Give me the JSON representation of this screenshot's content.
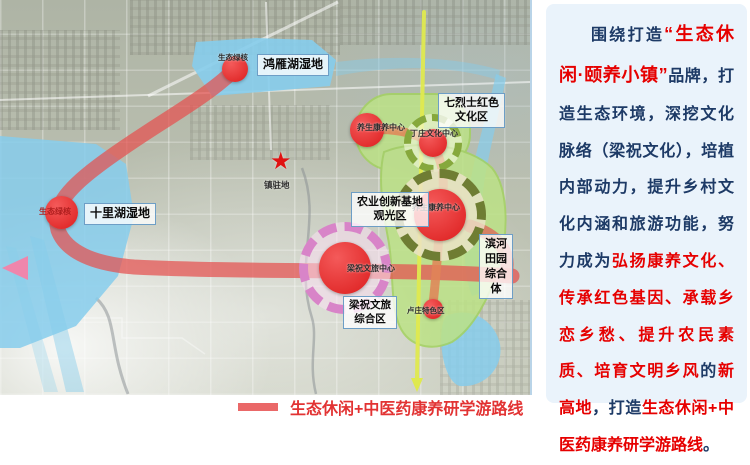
{
  "panel": {
    "segments": [
      {
        "style": "navy",
        "text": "围绕打造"
      },
      {
        "style": "brand",
        "text": "“生态休闲·颐养小镇”"
      },
      {
        "style": "navy",
        "text": "品牌，打造生态环境，深挖文化脉络（梁祝文化），培植内部动力，提升乡村文化内涵和旅游功能，努力成为"
      },
      {
        "style": "red",
        "text": "弘扬康养文化、传承红色基因、承载乡恋乡愁、提升农民素质、培育文明乡风"
      },
      {
        "style": "navy",
        "text": "的"
      },
      {
        "style": "red",
        "text": "新高地"
      },
      {
        "style": "navy",
        "text": "，打造"
      },
      {
        "style": "red",
        "text": "生态休闲+中医药康养研学游路线"
      },
      {
        "style": "navy",
        "text": "。"
      }
    ]
  },
  "legend": {
    "route_label": "生态休闲+中医药康养研学游路线"
  },
  "map": {
    "areas": {
      "hongyan_wetland": "鸿雁湖湿地",
      "shilihu_wetland": "十里湖湿地",
      "qilieshi_line1": "七烈士红色",
      "qilieshi_line2": "文化区",
      "nongye_line1": "农业创新基地",
      "nongye_line2": "观光区",
      "binhe_line1": "滨河",
      "binhe_line2": "田园",
      "binhe_line3": "综合",
      "binhe_line4": "体",
      "liangzhu_line1": "梁祝文旅",
      "liangzhu_line2": "综合区"
    },
    "nodes": {
      "eco_core_top": "生态绿核",
      "eco_core_west": "生态绿核",
      "yangsheng_center": "养生康养中心",
      "dingzhuang_center": "丁庄文化中心",
      "kangyang_center": "养生康养中心",
      "liangzhu_center": "梁祝文旅中心",
      "luzhuang_zone": "卢庄特色区",
      "town_seat": "镇驻地"
    }
  },
  "colors": {
    "brand_red": "#e60000",
    "navy": "#1d3a66",
    "route_red": "#e4504f",
    "water_blue": "#86cdec",
    "zone_green": "#bce286",
    "legend_red": "#e23333"
  }
}
